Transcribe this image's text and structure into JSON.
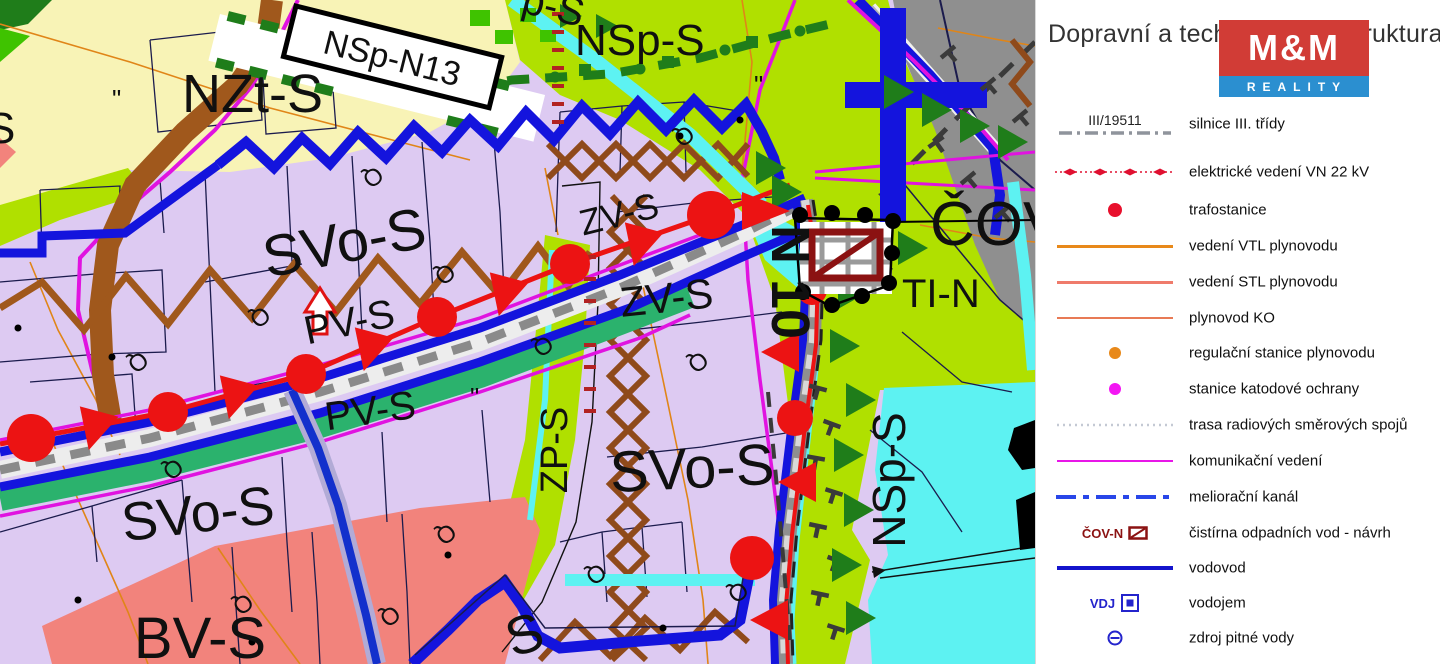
{
  "legend": {
    "title": "Dopravní a technická infrastruktura",
    "logo": {
      "top": "M&M",
      "bottom": "REALITY"
    },
    "items": [
      {
        "id": "silnice",
        "symbol_label": "III/19511",
        "label": "silnice III. třídy"
      },
      {
        "id": "vn22",
        "label": "elektrické vedení VN 22 kV"
      },
      {
        "id": "trafostanice",
        "label": "trafostanice"
      },
      {
        "id": "vtl",
        "label": "vedení VTL plynovodu"
      },
      {
        "id": "stl",
        "label": "vedení STL plynovodu"
      },
      {
        "id": "ko",
        "label": "plynovod KO"
      },
      {
        "id": "regulacni",
        "label": "regulační stanice plynovodu"
      },
      {
        "id": "katodova",
        "label": "stanice katodové ochrany"
      },
      {
        "id": "radio",
        "label": "trasa radiových směrových spojů"
      },
      {
        "id": "komunikacni",
        "label": "komunikační vedení"
      },
      {
        "id": "melioracni",
        "label": "meliorační kanál"
      },
      {
        "id": "cov",
        "symbol_label": "ČOV-N",
        "label": "čistírna odpadních vod - návrh"
      },
      {
        "id": "vodovod",
        "label": "vodovod"
      },
      {
        "id": "vodojem",
        "symbol_label": "VDJ",
        "label": "vodojem"
      },
      {
        "id": "zdroj",
        "label": "zdroj pitné vody"
      }
    ]
  },
  "map": {
    "labels": {
      "nzt": "NZt-S",
      "nsp_top": "NSp-S",
      "nsp_n13": "NSp-N13",
      "sp_cut_top": "p-S",
      "svo_1": "SVo-S",
      "svo_2": "SVo-S",
      "svo_3": "SVo-S",
      "zv_1": "ZV-S",
      "zv_2": "ZV-S",
      "pv_1": "PV-S",
      "pv_2": "PV-S",
      "zp": "ZP-S",
      "nsp_right": "NSp-S",
      "bv": "BV-S",
      "ti": "TI-N",
      "cov": "ČOV",
      "n10": "N 10",
      "s_cut_left": "S",
      "s_cut_bottom": "S"
    },
    "colors": {
      "zone_mixed_lavender": "#ddcaf2",
      "zone_agriculture_yellow": "#f8f3b6",
      "zone_landscape_green": "#b0e000",
      "zone_water_cyan": "#5df2f2",
      "zone_housing_salmon": "#f2837c",
      "zone_road_gray": "#8f8f8f",
      "vodovod_blue": "#1414dd",
      "komunikacni_magenta": "#e013e0",
      "elektro_red": "#ec1313",
      "cov_dark_red": "#8b1212",
      "kanalizace_brown": "#a0581c",
      "trees_dark_green": "#1f7d1a",
      "road_label_purple": "#46127a",
      "contour_orange": "#e08518",
      "legend_blue": "#2424cc",
      "logo_red": "#d13c36",
      "logo_blue": "#2b8fd0"
    }
  }
}
